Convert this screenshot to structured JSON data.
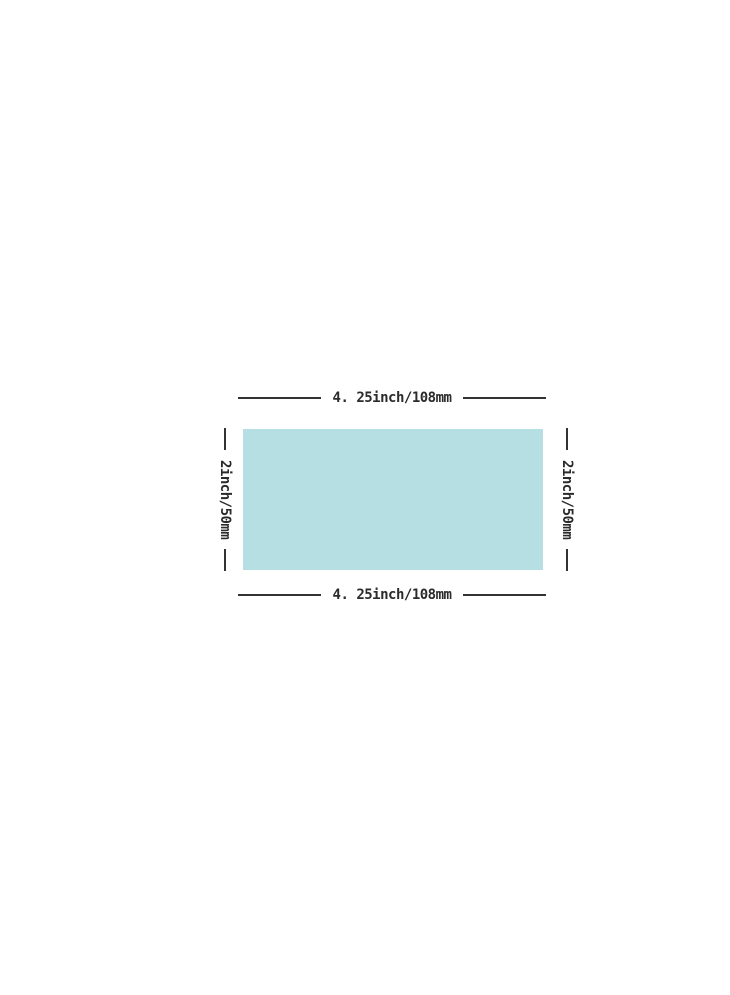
{
  "diagram": {
    "title": "product-dimension-diagram",
    "width_label_top": "4. 25inch/108mm",
    "width_label_bottom": "4. 25inch/108mm",
    "height_label_left": "2inch/50mm",
    "height_label_right": "2inch/50mm",
    "colors": {
      "rectangle_fill": "#b5dfe3",
      "dimension_line": "#333333",
      "label_text": "#2b2b2b",
      "background": "#ffffff"
    }
  }
}
